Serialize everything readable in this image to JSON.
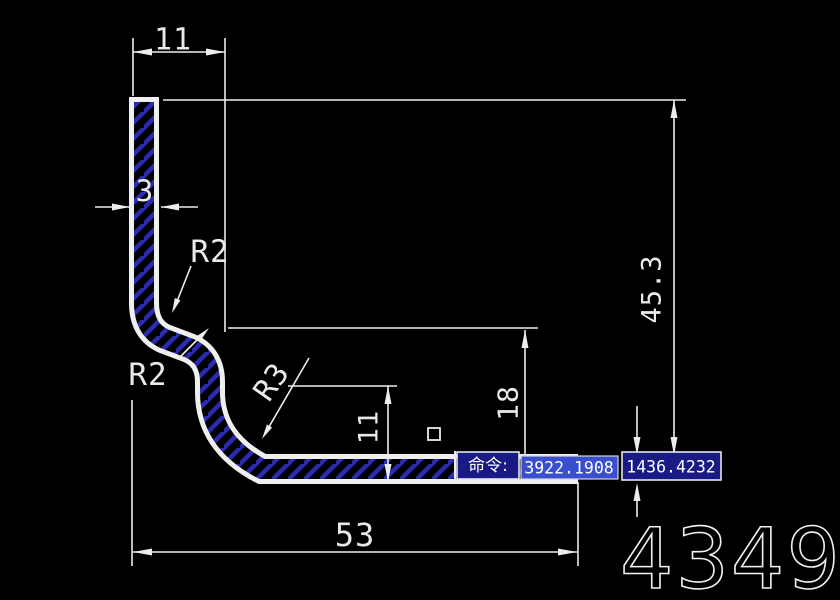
{
  "drawing": {
    "part_number": "4349",
    "dimensions": {
      "top_width": "11",
      "wall_thickness": "3",
      "radius_upper": "R2",
      "radius_lower": "R2",
      "radius_elbow": "R3",
      "flange_inner_height": "11",
      "step_height": "18",
      "total_height": "45.3",
      "total_width": "53"
    },
    "colors": {
      "line": "#ededed",
      "hatch": "#2b2bb4",
      "overlay_bg": "#1a1a85",
      "overlay_selected": "#3a4fd0"
    }
  },
  "command_bar": {
    "prompt": "命令:",
    "coord_x": "3922.1908",
    "coord_y": "1436.4232"
  }
}
